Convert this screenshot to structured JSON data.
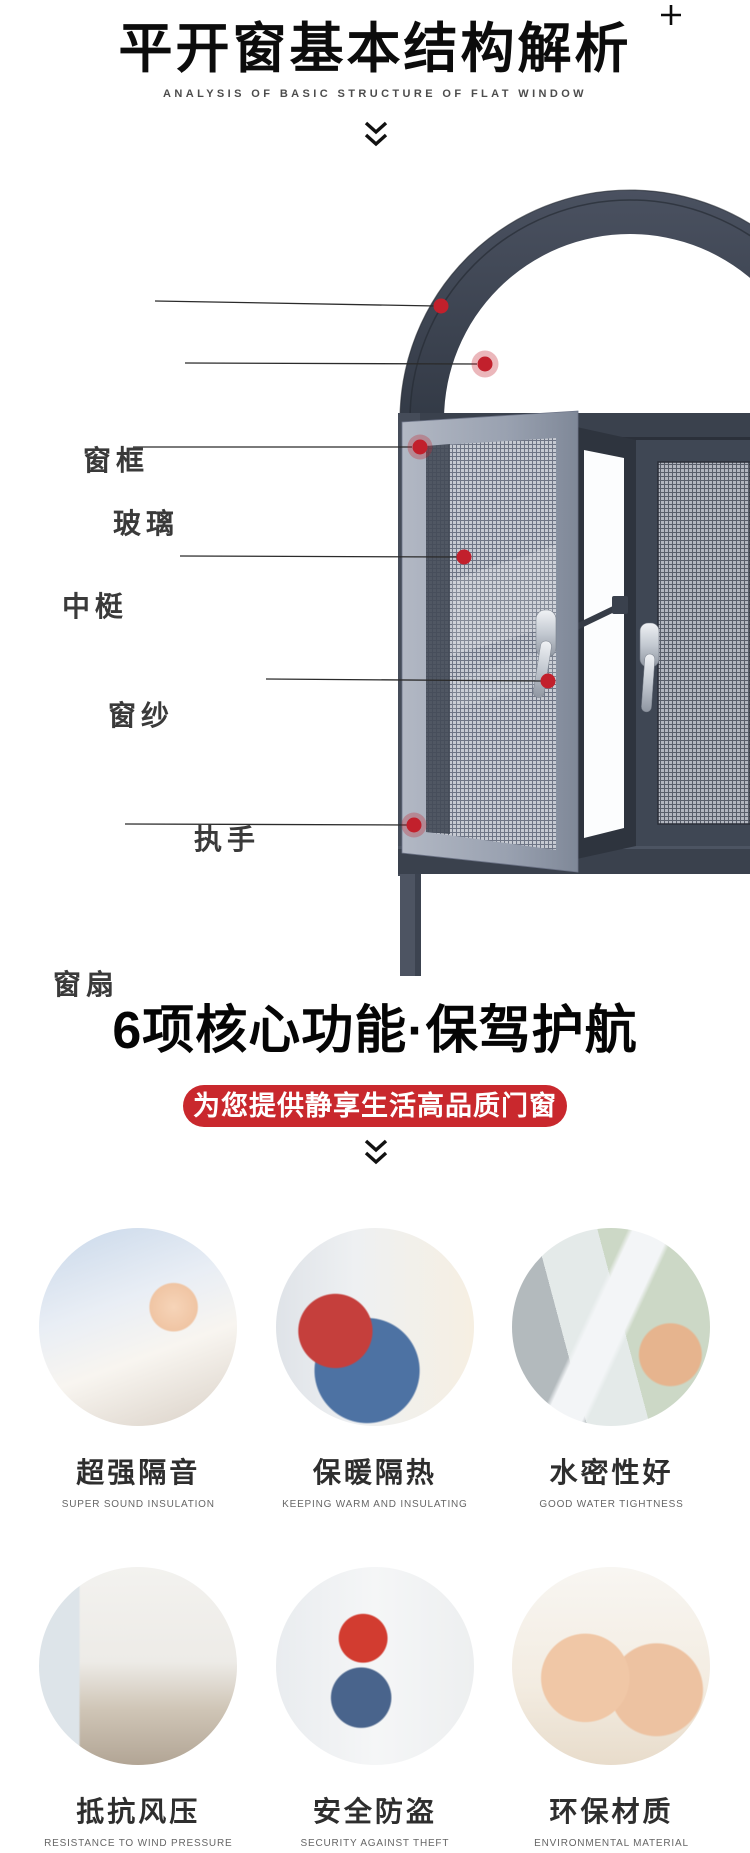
{
  "header": {
    "title": "平开窗基本结构解析",
    "subtitle": "ANALYSIS OF BASIC STRUCTURE OF FLAT WINDOW",
    "corner_icon": "plus-icon",
    "divider_icon": "double-chevron-down-icon"
  },
  "diagram": {
    "labels": [
      {
        "text": "窗框"
      },
      {
        "text": "玻璃"
      },
      {
        "text": "中梃"
      },
      {
        "text": "窗纱"
      },
      {
        "text": "执手"
      },
      {
        "text": "窗扇"
      }
    ]
  },
  "section2": {
    "title": "6项核心功能·保驾护航",
    "banner": "为您提供静享生活高品质门窗"
  },
  "features": [
    {
      "title": "超强隔音",
      "subtitle": "SUPER SOUND INSULATION",
      "photo": "sleeping-baby"
    },
    {
      "title": "保暖隔热",
      "subtitle": "KEEPING WARM AND INSULATING",
      "photo": "child-at-window"
    },
    {
      "title": "水密性好",
      "subtitle": "GOOD WATER TIGHTNESS",
      "photo": "handle-in-rain"
    },
    {
      "title": "抵抗风压",
      "subtitle": "RESISTANCE TO WIND PRESSURE",
      "photo": "living-room"
    },
    {
      "title": "安全防盗",
      "subtitle": "SECURITY AGAINST THEFT",
      "photo": "woman-at-window"
    },
    {
      "title": "环保材质",
      "subtitle": "ENVIRONMENTAL MATERIAL",
      "photo": "babies"
    }
  ],
  "colors": {
    "accent_red": "#c2202c",
    "banner_red": "#c9282d",
    "frame_dark": "#3a414d",
    "sash_gray": "#9aa2b1",
    "title_black": "#0c0c0c"
  }
}
